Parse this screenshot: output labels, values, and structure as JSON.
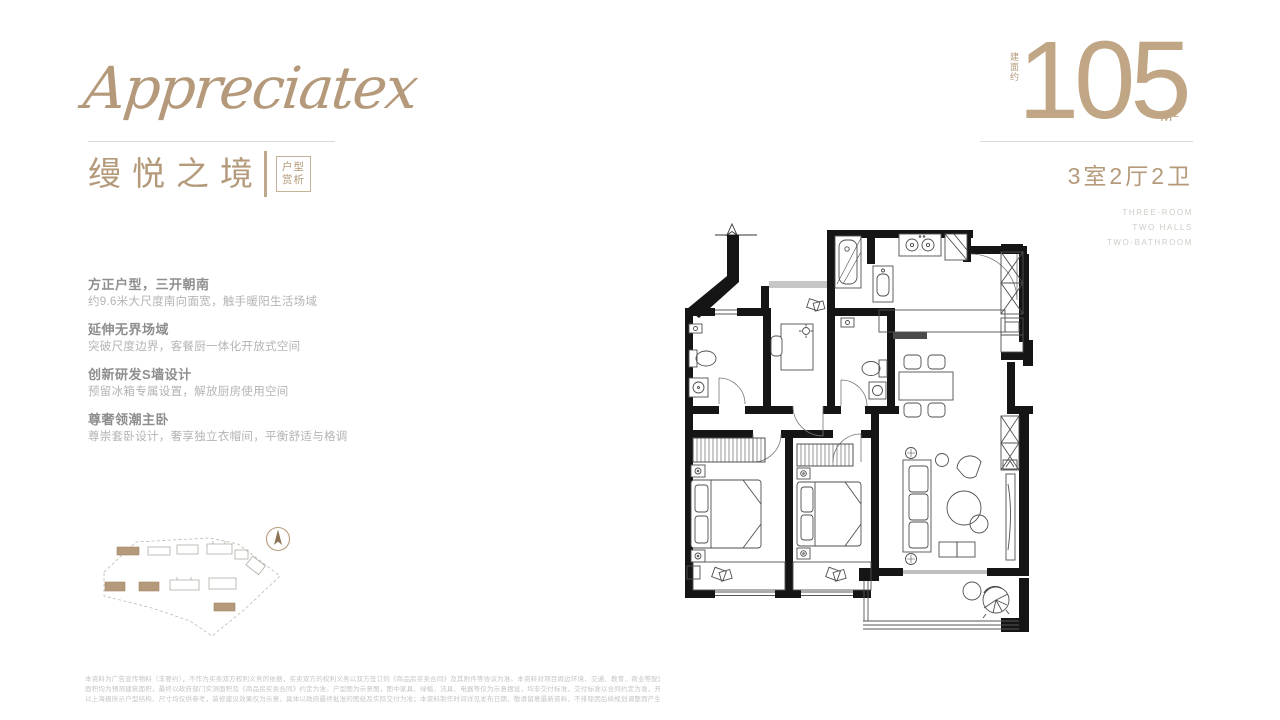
{
  "brand": {
    "logo": "Appreciatex"
  },
  "title": {
    "cn": "缦悦之境",
    "tag1": "户型",
    "tag2": "赏析"
  },
  "area": {
    "vertical_label": "建面约",
    "value": "105",
    "unit": "M²",
    "layout_cn": "3室2厅2卫",
    "layout_en1": "THREE-ROOM",
    "layout_en2": "TWO HALLS",
    "layout_en3": "TWO-BATHROOM"
  },
  "features": [
    {
      "title": "方正户型，三开朝南",
      "desc": "约9.6米大尺度南向面宽，触手暖阳生活场域"
    },
    {
      "title": "延伸无界场域",
      "desc": "突破尺度边界，客餐厨一体化开放式空间"
    },
    {
      "title": "创新研发S墙设计",
      "desc": "预留冰箱专属设置，解放厨房使用空间"
    },
    {
      "title": "尊奢领潮主卧",
      "desc": "尊崇套卧设计，奢享独立衣帽间，平衡舒适与格调"
    }
  ],
  "disclaimer": [
    "本资料为广告宣传物料（非要约），不作为买卖双方权利义务的依据，买卖双方的权利义务以双方签订的《商品房买卖合同》及其附件等协议为准。本资料对项目周边环境、交通、教育、商业等配套的介绍旨在提供相关信息，不代表本公司对此作出承诺。部分图片、文字来源于网络，如涉及侵权请联系删除。",
    "面积均为预测建筑面积，最终以政府部门实测面积及《商品房买卖合同》约定为准。户型图为示意图，图中家具、绿植、洁具、电器等仅为示意摆设，均非交付标准，交付标准以合同约定为准，开发商保留对宣传资料修改的权利。",
    "以上海报所示户型结构、尺寸均仅供参考，装修建议效果仅为示意，具体以政府最终批准的图纸及实际交付为准；本资料制作时间详见发布日期，敬请留意最新资料，不排除因后续规划调整而产生变化。"
  ],
  "colors": {
    "accent": "#b49a7a",
    "wall": "#151515"
  }
}
